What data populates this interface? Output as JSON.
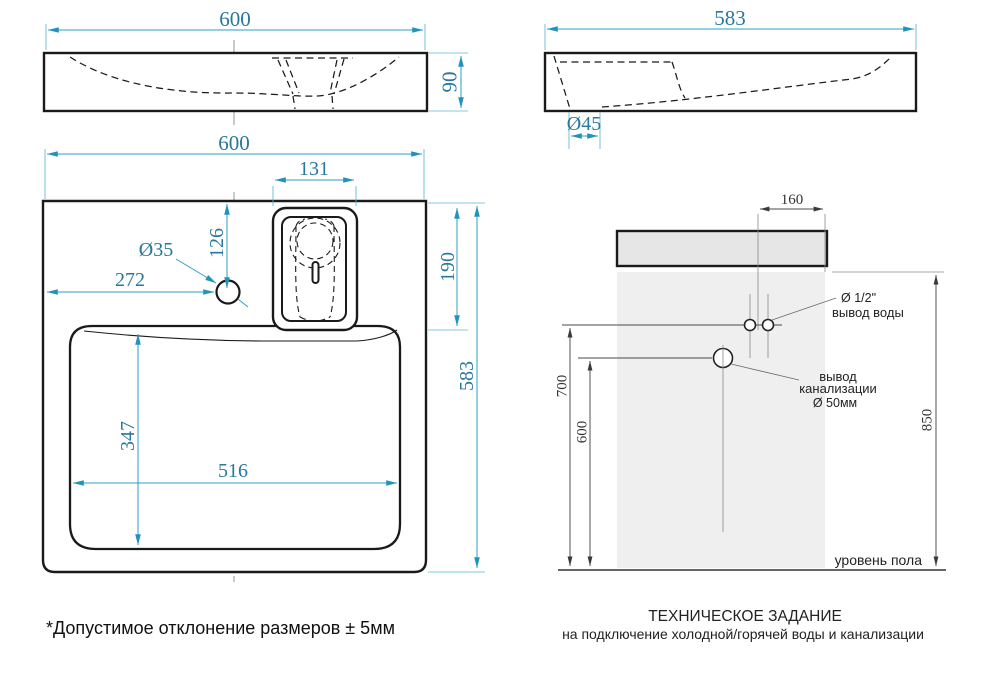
{
  "colors": {
    "dimension_text_blue": "#27789b",
    "dimension_line_blue": "#2e9fc4",
    "dimension_black": "#3a3a3a",
    "ink": "#1a1a1a",
    "sink_fill": "#e6e6e6",
    "wall_fill": "#efefef"
  },
  "front_view": {
    "width": "600",
    "height": "90"
  },
  "side_view": {
    "width": "583",
    "drain_hole": "Ø45"
  },
  "plan_view": {
    "width": "600",
    "recess_width": "131",
    "tap_from_back": "126",
    "tap_hole": "Ø35",
    "tap_from_left": "272",
    "recess_length": "190",
    "depth": "583",
    "bowl_depth": "347",
    "bowl_width": "516"
  },
  "installation": {
    "tap_offset": "160",
    "water_height": "700",
    "drain_height": "600",
    "rim_height": "850",
    "water_size": "Ø 1/2\"",
    "water_label": "вывод воды",
    "drain_label_line1": "вывод",
    "drain_label_line2": "канализации",
    "drain_size": "Ø 50мм",
    "floor_label": "уровень пола"
  },
  "footer": {
    "note": "*Допустимое отклонение размеров ± 5мм",
    "title": "ТЕХНИЧЕСКОЕ ЗАДАНИЕ",
    "subtitle": "на подключение холодной/горячей воды и канализации"
  }
}
